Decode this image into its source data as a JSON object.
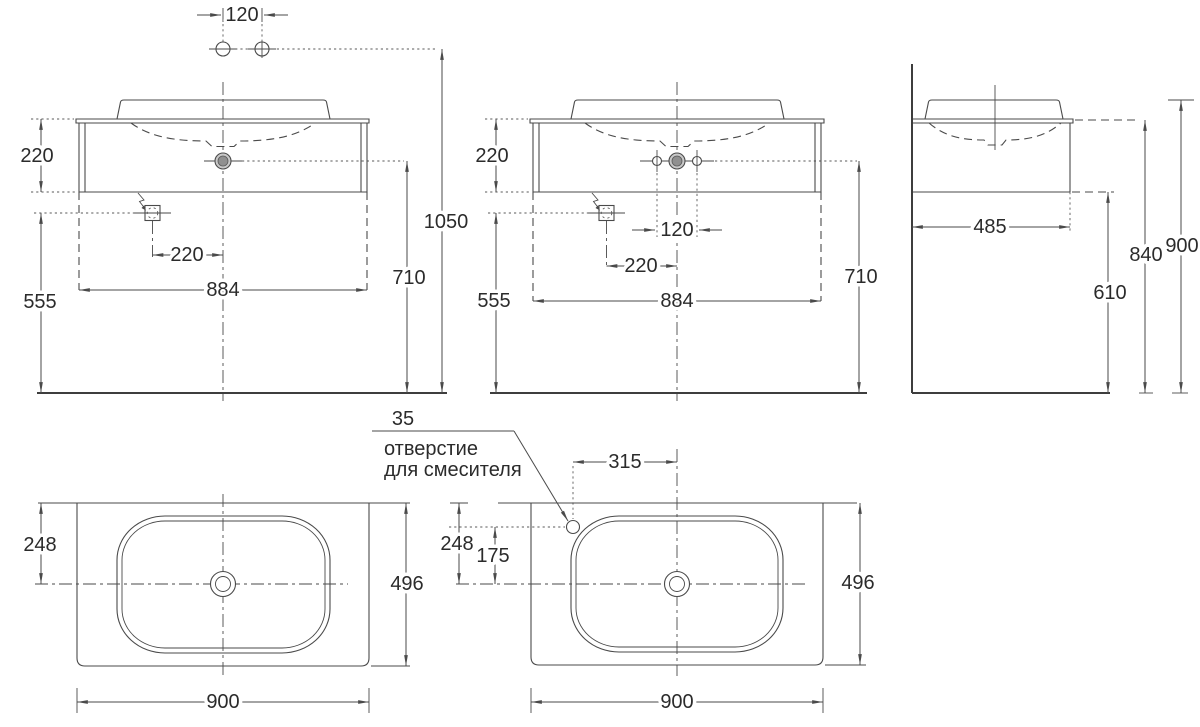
{
  "meta": {
    "drawing_type": "washbasin-vanity-dimensional-drawing",
    "units": "mm",
    "background_color": "#ffffff",
    "line_color": "#4a4a4a",
    "text_color": "#2b2b2b",
    "drain_fill_color": "#c9c9c9"
  },
  "views": {
    "front_left": {
      "supply_hole_spacing": "120",
      "worktop_height": "220",
      "outlet_to_floor": "555",
      "outlet_offset": "220",
      "body_width": "884",
      "drain_height": "710",
      "supply_height": "1050"
    },
    "front_center": {
      "worktop_height": "220",
      "outlet_to_floor": "555",
      "fixing_hole_spacing": "120",
      "outlet_offset": "220",
      "body_width": "884",
      "drain_height": "710"
    },
    "side": {
      "depth": "485",
      "underside_height": "610",
      "worktop_height": "840",
      "overall_height": "900"
    },
    "plan_left": {
      "drain_setback": "248",
      "depth": "496",
      "width": "900"
    },
    "plan_right": {
      "hole_diameter": "35",
      "note_line1": "отверстие",
      "note_line2": "для смесителя",
      "faucet_offset": "315",
      "drain_setback": "248",
      "faucet_setback": "175",
      "depth": "496",
      "width": "900"
    }
  }
}
